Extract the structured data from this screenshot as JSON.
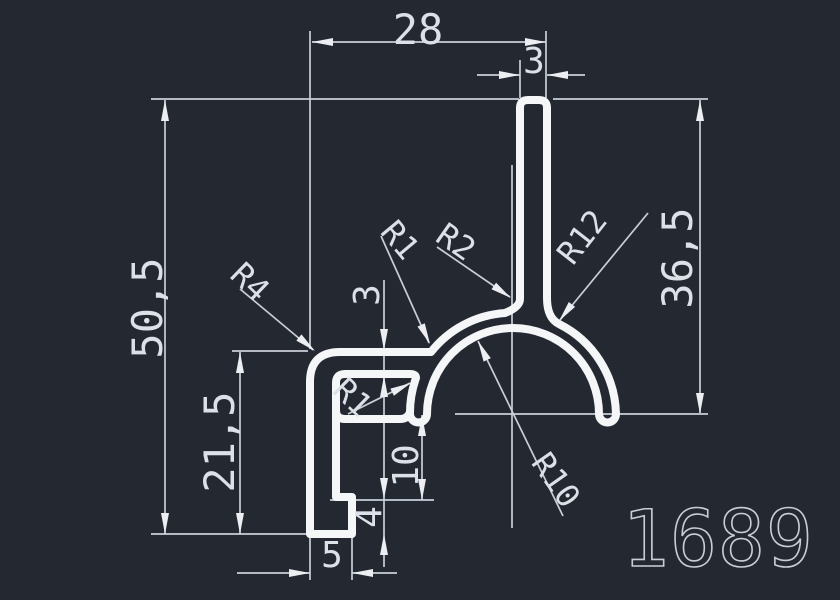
{
  "drawing": {
    "part_number": "1689",
    "colors": {
      "background": "#232831",
      "profile_line": "#f4f6f8",
      "dimension_line": "#c9cfd8",
      "dimension_text": "#dce1e7",
      "part_number_text": "#c9ced6"
    },
    "linear_dimensions": {
      "overall_width": "28",
      "stem_width": "3",
      "overall_height": "50,5",
      "right_height": "36,5",
      "left_height": "21,5",
      "arm_thickness": "3",
      "inner_drop": "10",
      "foot_height": "4",
      "foot_width": "5"
    },
    "radius_labels": {
      "r4_corner": "R4",
      "r1_arm_fillet": "R1",
      "r2_stem_fillet": "R2",
      "r12_outer_arc": "R12",
      "r10_inner_arc": "R10",
      "r1_slot_corner": "R1"
    }
  }
}
